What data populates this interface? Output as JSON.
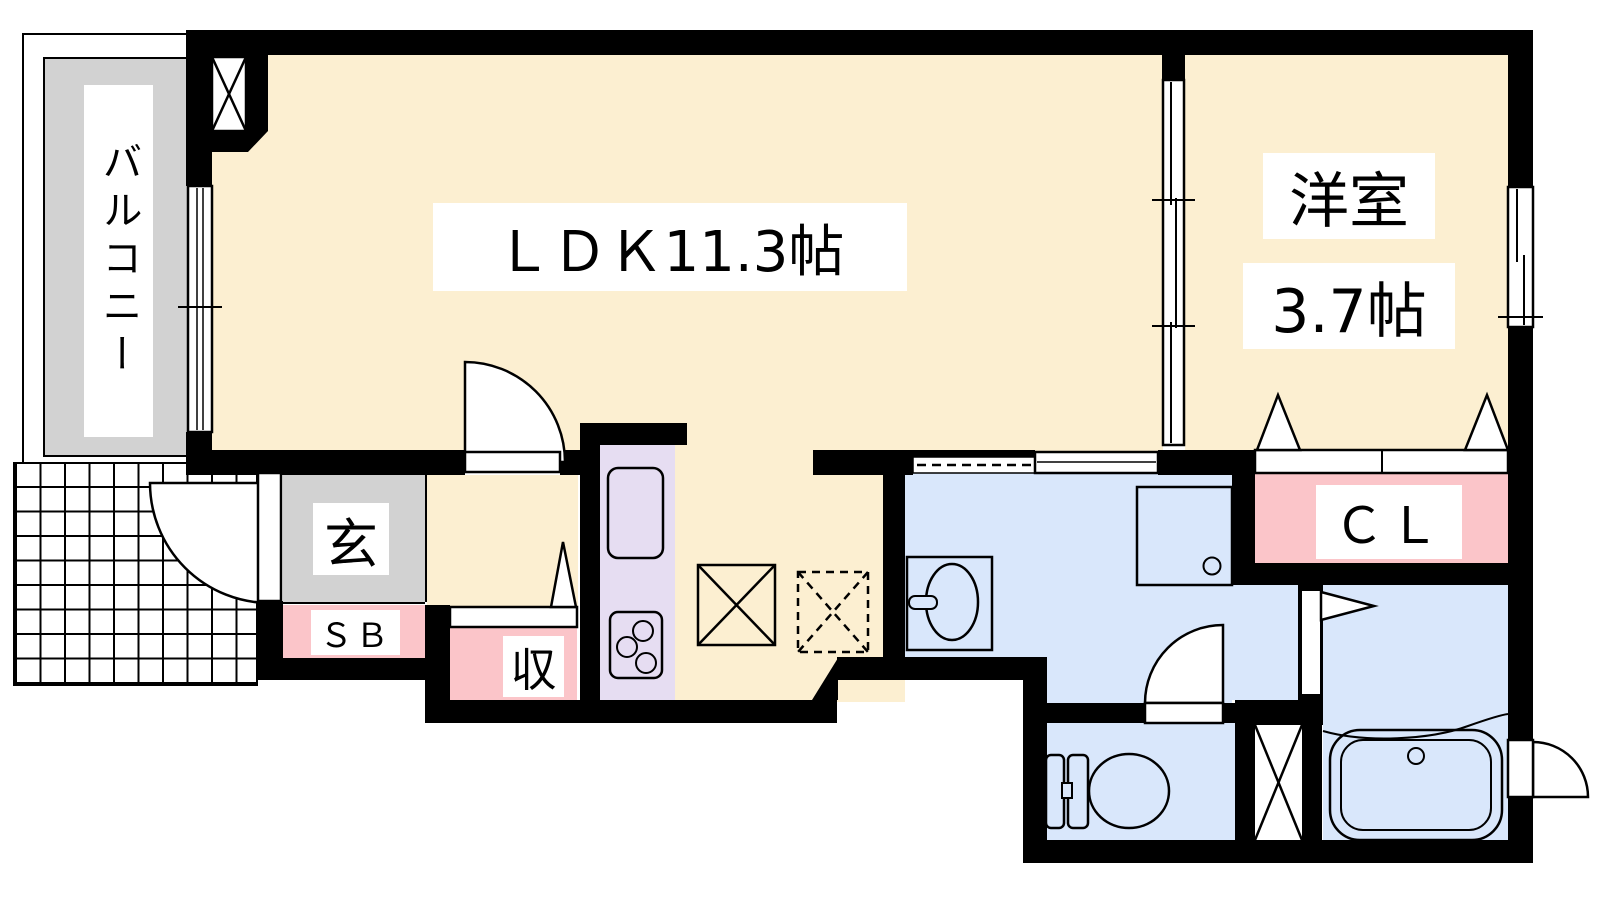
{
  "title": "1K apartment floor plan",
  "rooms": {
    "balcony": {
      "label": "バルコニー"
    },
    "ldk": {
      "label": "ＬＤＫ11.3帖"
    },
    "western_room": {
      "name": "洋室",
      "size": "3.7帖"
    },
    "entrance": {
      "label": "玄"
    },
    "shoe_box": {
      "label": "ＳＢ"
    },
    "storage": {
      "label": "収"
    },
    "closet": {
      "label": "ＣＬ"
    }
  },
  "colors": {
    "floor_cream": "#FCEFD1",
    "wet_area_blue": "#D9E7FB",
    "kitchen_purple": "#E6DDF2",
    "closet_pink": "#FBC5C9",
    "balcony_gray": "#D2D2D2",
    "wall_black": "#000000",
    "background": "#FFFFFF"
  },
  "icons": [
    "shaft-x-icon",
    "refrigerator-space-icon",
    "washer-space-dashed-icon",
    "pipe-space-icon",
    "kitchen-sink-icon",
    "stove-icon",
    "washbasin-icon",
    "washing-machine-pan-icon",
    "toilet-icon",
    "bathtub-icon",
    "entrance-door-swing-icon",
    "ldk-door-swing-icon",
    "toilet-door-swing-icon",
    "bath-outside-door-swing-icon",
    "bath-folding-door-icon",
    "pocket-sliding-door-icon",
    "closet-folding-door-icon",
    "storage-door-icon",
    "balcony-window-icon",
    "partition-window-icon",
    "bedroom-window-icon"
  ]
}
